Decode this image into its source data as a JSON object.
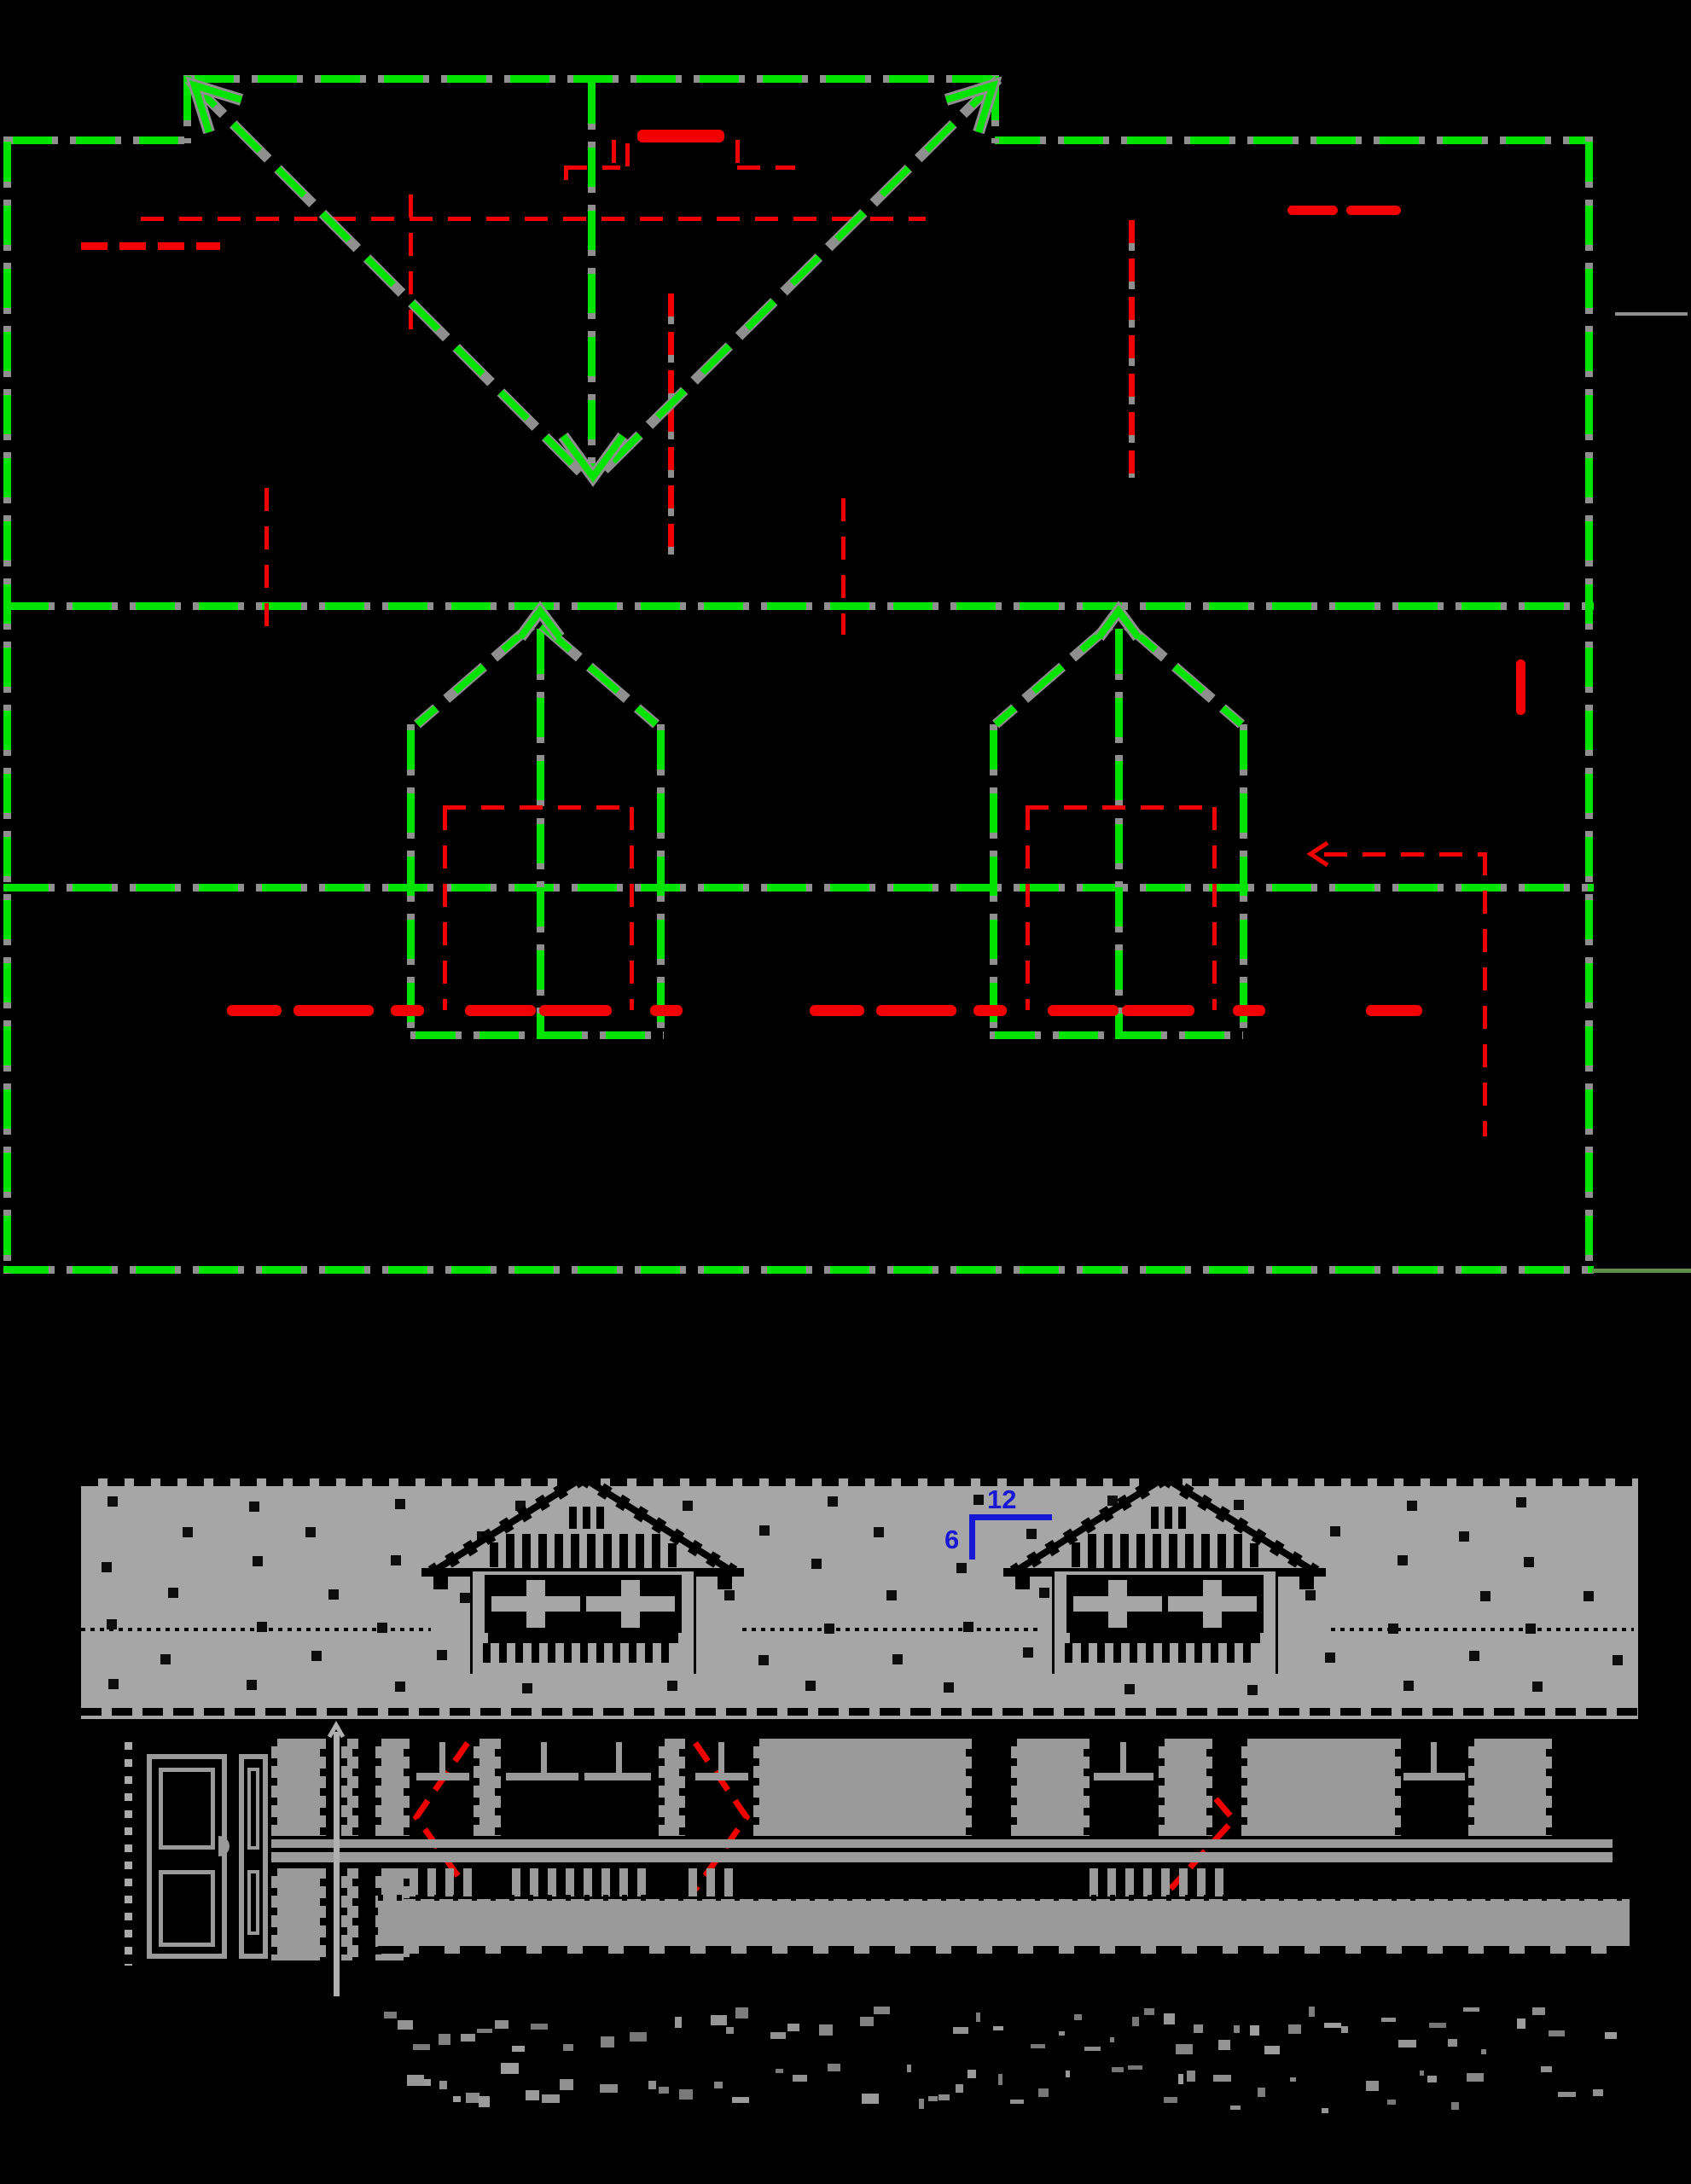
{
  "drawing": {
    "kind": "architectural CAD drawing",
    "views": [
      "roof plan",
      "dormer elevation",
      "wall framing section"
    ],
    "dormer_count": 2,
    "caption_legible": false
  },
  "annotations": {
    "pitch_rise": "12",
    "pitch_run": "6"
  },
  "colors": {
    "background": "#000000",
    "green": "#00e400",
    "gray_line": "#8f8f8f",
    "red": "#f20000",
    "wall_gray": "#a6a6a6",
    "member_gray": "#9a9a9a",
    "blue": "#1717d6",
    "speck": "#0d0d0d",
    "olive": "#5d8f4a"
  },
  "icons": [
    {
      "name": "valley-direction-arrow-down"
    },
    {
      "name": "ridge-direction-arrow-up-left"
    },
    {
      "name": "ridge-direction-arrow-up-right"
    },
    {
      "name": "dormer-ridge-arrow-up"
    },
    {
      "name": "swing-direction-chevron"
    },
    {
      "name": "leader-arrow-left"
    }
  ]
}
